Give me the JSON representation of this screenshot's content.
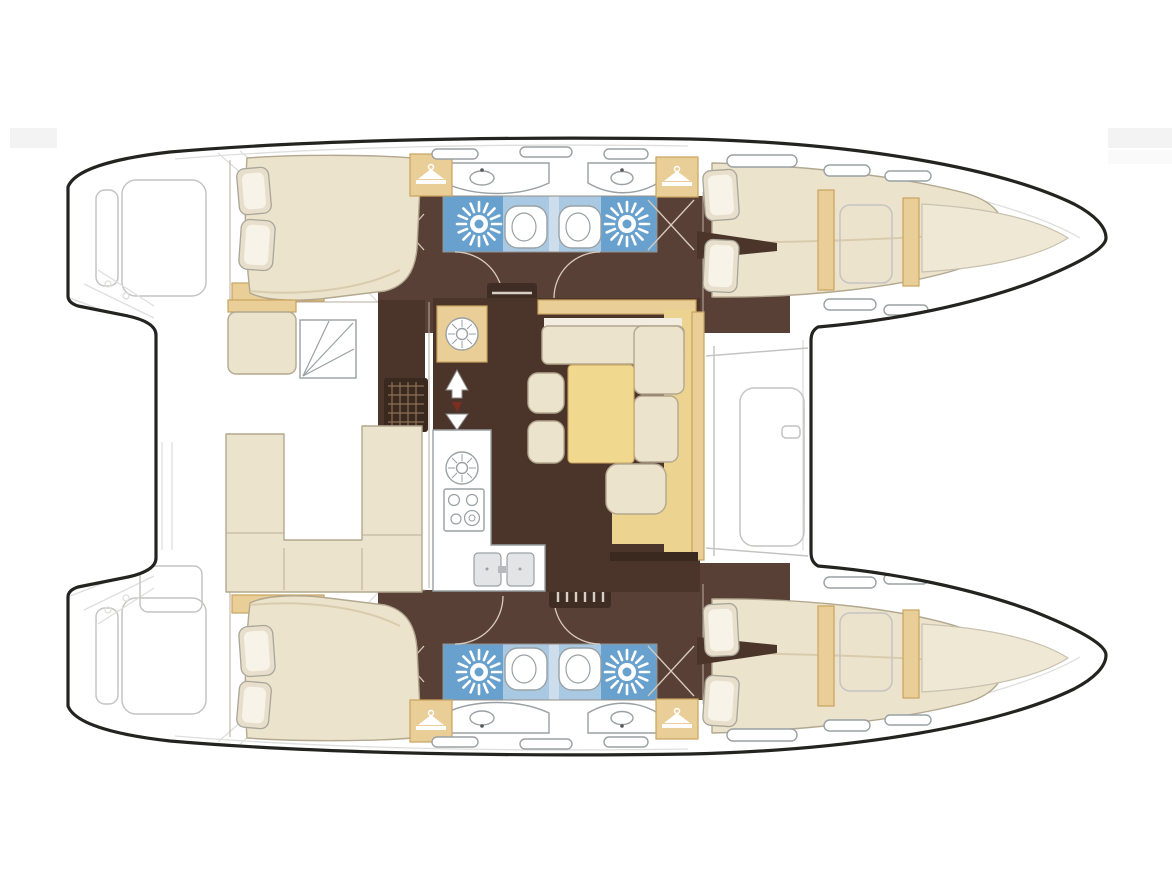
{
  "meta": {
    "title": "Catamaran interior layout floor plan, top-down view, bows pointing right",
    "type": "boat-floor-plan",
    "canvas": {
      "width": 1172,
      "height": 879
    }
  },
  "palette": {
    "paper": "#ffffff",
    "outline": "#23231f",
    "line_gray": "#c4c4c2",
    "wall_line": "#b9ae9c",
    "door_line": "#d8cbbc",
    "floor_dark": "#4b352b",
    "floor_corridor": "#584037",
    "cream": "#ece3cd",
    "cream_shade": "#d9cbae",
    "cream_outline": "#b3a88f",
    "pillow": "#e7dfcb",
    "pillow_outline": "#a9a598",
    "tan": "#e9cf97",
    "tan_dark": "#c8a35e",
    "blue": "#68a1cd",
    "blue_light": "#a9c8e2",
    "blue_pale": "#cdddec",
    "fixture_outline": "#9aa0a4",
    "steel": "#e2e4e6",
    "table_yellow": "#f0d98e",
    "platform_yellow": "#ecd38f",
    "grate": "#39291f",
    "grate_dot": "#8d7054",
    "ladder": "#3f2d24",
    "ladder_rung": "#d8cfc4",
    "arrow_red": "#7c2e21",
    "watermark": "#f3f3f3"
  },
  "legend": {
    "double_cabins": 4,
    "bathrooms_with_shower": 4,
    "bow_berths": 2,
    "hulls": 2
  },
  "vessel": {
    "orientation": "bows-right",
    "hulls": [
      {
        "id": "port-hull",
        "position": "top",
        "rooms": [
          {
            "id": "aft-cabin",
            "fixtures": [
              "double-berth",
              "pillows",
              "wardrobe-hanger",
              "step-cabinet"
            ]
          },
          {
            "id": "aft-head",
            "fixtures": [
              "shower-drain",
              "toilet",
              "vanity-basin"
            ]
          },
          {
            "id": "forward-head",
            "fixtures": [
              "shower-drain",
              "toilet",
              "vanity-basin"
            ]
          },
          {
            "id": "forward-cabin",
            "fixtures": [
              "tapered-double-berth",
              "pillows",
              "wardrobe-hanger"
            ]
          },
          {
            "id": "forepeak",
            "fixtures": [
              "storage-hatch",
              "bow-berth"
            ]
          }
        ],
        "companionway": "ladder-to-saloon"
      },
      {
        "id": "starboard-hull",
        "position": "bottom",
        "rooms": [
          {
            "id": "aft-cabin",
            "fixtures": [
              "double-berth",
              "pillows",
              "wardrobe-hanger",
              "step-cabinet"
            ]
          },
          {
            "id": "aft-head",
            "fixtures": [
              "shower-drain",
              "toilet",
              "vanity-basin"
            ]
          },
          {
            "id": "forward-head",
            "fixtures": [
              "shower-drain",
              "toilet",
              "vanity-basin"
            ]
          },
          {
            "id": "forward-cabin",
            "fixtures": [
              "tapered-double-berth",
              "pillows",
              "wardrobe-hanger"
            ]
          },
          {
            "id": "forepeak",
            "fixtures": [
              "storage-hatch",
              "bow-berth"
            ]
          }
        ],
        "companionway": "ladder-to-saloon"
      }
    ],
    "bridgedeck": {
      "rooms": [
        {
          "id": "aft-cockpit",
          "fixtures": [
            "helm-seat",
            "deck-steps",
            "deck-grate",
            "u-shaped-settee"
          ]
        },
        {
          "id": "saloon",
          "fixtures": [
            "galley-cabinet",
            "round-sink",
            "worktop",
            "gas-stove",
            "double-sink",
            "companionway-arrows",
            "dinette-table",
            "l-shaped-sofa",
            "stools",
            "lounge-cushion",
            "sideboard"
          ]
        },
        {
          "id": "foredeck",
          "fixtures": [
            "forward-bench-outline",
            "windshield-edge"
          ]
        }
      ]
    },
    "sterns": {
      "features": [
        "swim-platforms",
        "transom-steps",
        "davit-lines"
      ]
    }
  }
}
